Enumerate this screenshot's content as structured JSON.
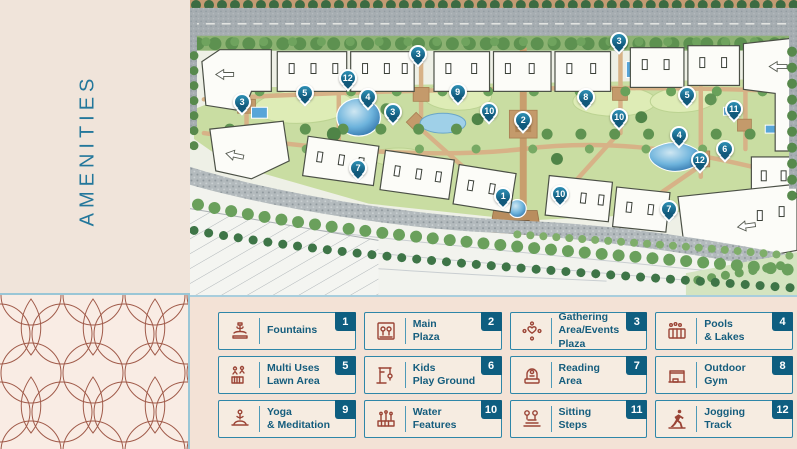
{
  "sidebar": {
    "title": "AMENITIES"
  },
  "colors": {
    "accent_teal": "#1f7396",
    "badge_navy": "#0e5e80",
    "icon_maroon": "#9b4436",
    "panel_cream": "#f2e2d5",
    "pattern_line": "#a05a49",
    "water_blue": "#57a5d8",
    "lawn_green": "#cfe0a8",
    "road_gray": "#a6adb1"
  },
  "legend": {
    "items": [
      {
        "num": "1",
        "label": "Fountains",
        "icon": "fountain-icon"
      },
      {
        "num": "2",
        "label": "Main\nPlaza",
        "icon": "main-plaza-icon"
      },
      {
        "num": "3",
        "label": "Gathering\nArea/Events Plaza",
        "icon": "gathering-icon"
      },
      {
        "num": "4",
        "label": "Pools\n& Lakes",
        "icon": "pools-lakes-icon"
      },
      {
        "num": "5",
        "label": "Multi Uses\nLawn Area",
        "icon": "lawn-area-icon"
      },
      {
        "num": "6",
        "label": "Kids\nPlay Ground",
        "icon": "kids-playground-icon"
      },
      {
        "num": "7",
        "label": "Reading\nArea",
        "icon": "reading-area-icon"
      },
      {
        "num": "8",
        "label": "Outdoor\nGym",
        "icon": "outdoor-gym-icon"
      },
      {
        "num": "9",
        "label": "Yoga\n& Meditation",
        "icon": "yoga-icon"
      },
      {
        "num": "10",
        "label": "Water\nFeatures",
        "icon": "water-features-icon"
      },
      {
        "num": "11",
        "label": "Sitting\nSteps",
        "icon": "sitting-steps-icon"
      },
      {
        "num": "12",
        "label": "Jogging\nTrack",
        "icon": "jogging-track-icon"
      }
    ]
  },
  "map": {
    "markers": [
      {
        "num": "3",
        "x": 8.6,
        "y": 36.0
      },
      {
        "num": "5",
        "x": 18.9,
        "y": 33.0
      },
      {
        "num": "12",
        "x": 26.0,
        "y": 27.9
      },
      {
        "num": "4",
        "x": 29.3,
        "y": 34.3
      },
      {
        "num": "3",
        "x": 33.4,
        "y": 39.4
      },
      {
        "num": "3",
        "x": 37.6,
        "y": 19.5
      },
      {
        "num": "9",
        "x": 44.1,
        "y": 32.7
      },
      {
        "num": "10",
        "x": 49.3,
        "y": 39.1
      },
      {
        "num": "2",
        "x": 54.9,
        "y": 42.1
      },
      {
        "num": "8",
        "x": 65.2,
        "y": 34.3
      },
      {
        "num": "3",
        "x": 70.7,
        "y": 15.2
      },
      {
        "num": "10",
        "x": 70.7,
        "y": 41.1
      },
      {
        "num": "5",
        "x": 81.9,
        "y": 33.7
      },
      {
        "num": "11",
        "x": 89.6,
        "y": 38.4
      },
      {
        "num": "4",
        "x": 80.6,
        "y": 47.1
      },
      {
        "num": "6",
        "x": 88.1,
        "y": 51.9
      },
      {
        "num": "12",
        "x": 84.0,
        "y": 55.6
      },
      {
        "num": "1",
        "x": 51.6,
        "y": 67.7
      },
      {
        "num": "10",
        "x": 61.0,
        "y": 67.0
      },
      {
        "num": "7",
        "x": 78.9,
        "y": 72.1
      },
      {
        "num": "7",
        "x": 27.7,
        "y": 58.2
      }
    ]
  }
}
